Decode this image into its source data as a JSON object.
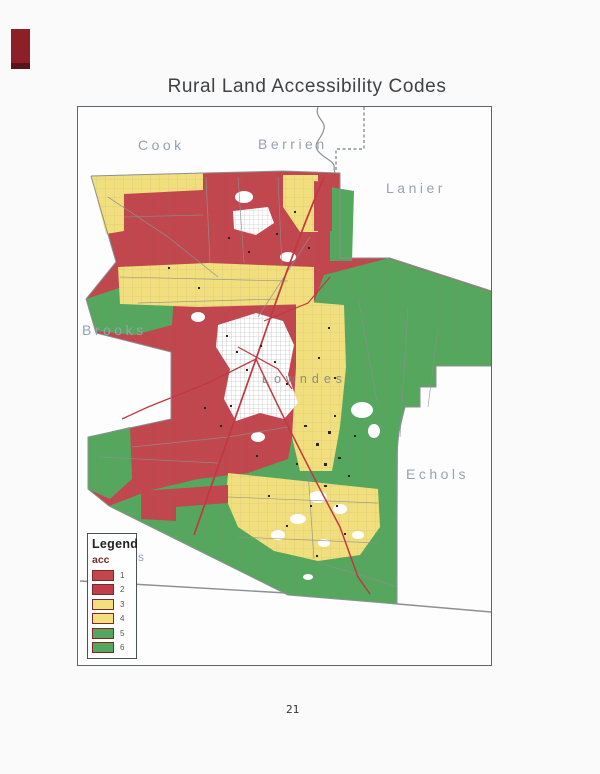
{
  "page": {
    "title": "Rural Land Accessibility Codes",
    "page_number": "21"
  },
  "map_labels": {
    "cook": "Cook",
    "berrien": "Berrien",
    "lanier": "Lanier",
    "brooks": "Brooks",
    "echols": "Echols",
    "lowndes": "Lowndes",
    "stray": "s"
  },
  "legend": {
    "title": "Legend",
    "field_name": "acc",
    "items": [
      {
        "label": "1",
        "color": "#c2464e"
      },
      {
        "label": "2",
        "color": "#bf3f48"
      },
      {
        "label": "3",
        "color": "#f3e07c"
      },
      {
        "label": "4",
        "color": "#f3e07c"
      },
      {
        "label": "5",
        "color": "#55a75e"
      },
      {
        "label": "6",
        "color": "#55a75e"
      }
    ]
  },
  "map_colors": {
    "acc_red": "#c2464e",
    "acc_yellow": "#f1df7d",
    "acc_green": "#55a75e",
    "urban_white": "#ffffff",
    "boundary_grey": "#8a9094",
    "road_red": "#c23840",
    "road_grey": "#8f8f8f",
    "speckle": "#2a2624"
  },
  "artifact": {
    "color": "#8b2026"
  }
}
